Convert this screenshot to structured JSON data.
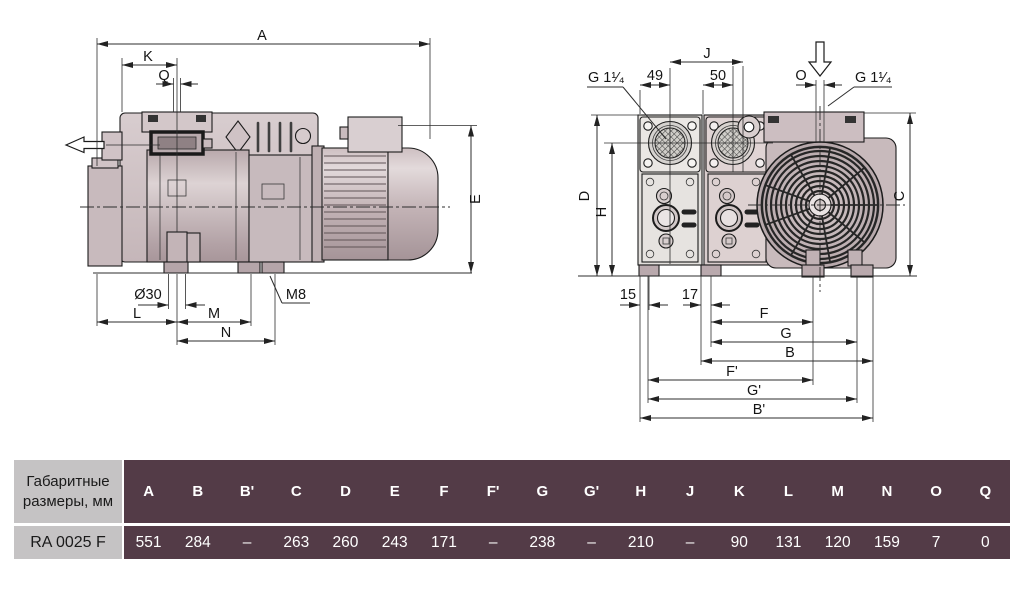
{
  "drawing": {
    "side_view": {
      "labels": {
        "a": "A",
        "k": "K",
        "q": "Q",
        "e": "E",
        "dia": "Ø30",
        "l": "L",
        "m": "M",
        "n": "N",
        "m8": "M8"
      }
    },
    "rear_view": {
      "labels": {
        "g114_left": "G 1¹⁄₄",
        "g114_right": "G 1¹⁄₄",
        "d49": "49",
        "j": "J",
        "d50": "50",
        "o": "O",
        "d": "D",
        "h": "H",
        "c": "C",
        "d15": "15",
        "d17": "17",
        "f": "F",
        "g": "G",
        "b": "B",
        "f2": "F'",
        "g2": "G'",
        "b2": "B'"
      }
    }
  },
  "table": {
    "corner_label": "Габаритные размеры, мм",
    "model": "RA 0025 F",
    "columns": [
      "A",
      "B",
      "B'",
      "C",
      "D",
      "E",
      "F",
      "F'",
      "G",
      "G'",
      "H",
      "J",
      "K",
      "L",
      "M",
      "N",
      "O",
      "Q"
    ],
    "values": [
      "551",
      "284",
      "–",
      "263",
      "260",
      "243",
      "171",
      "–",
      "238",
      "–",
      "210",
      "–",
      "90",
      "131",
      "120",
      "159",
      "7",
      "0"
    ]
  },
  "colors": {
    "table_header_bg": "#533b47",
    "table_side_bg": "#c5c3c4",
    "body_fill": "#cdbfc2",
    "line": "#1c1c1c"
  }
}
